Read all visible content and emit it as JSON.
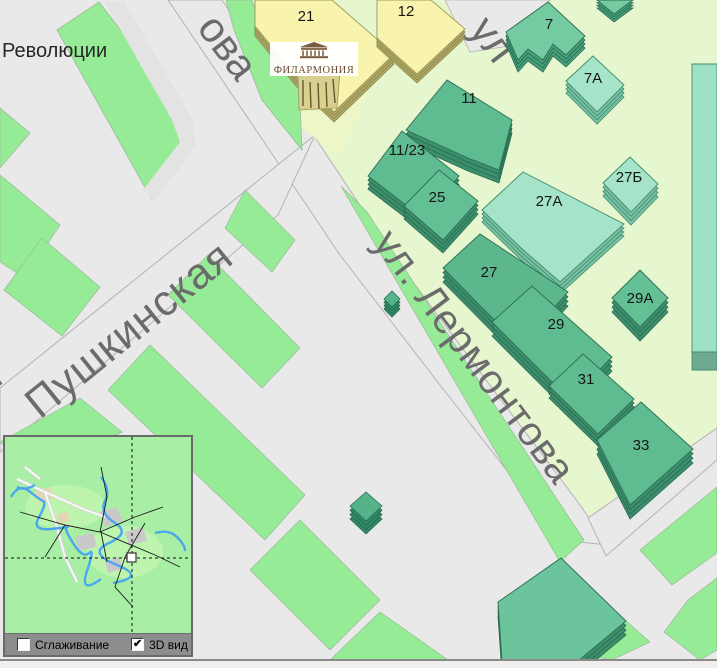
{
  "app": {
    "type": "gis-map-viewer",
    "view": "2.5D city map with overview inset"
  },
  "streets": {
    "revolution_square": "Революции",
    "pushkinskaya": "Пушкинская",
    "lermontova": "ул. Лермонтова",
    "lermontova_partial_top": "ова",
    "cross_street_partial_top": "ул",
    "edge_partial_left": "я"
  },
  "poi": {
    "philharmonic_label": "ФИЛАРМОНИЯ"
  },
  "buildings": {
    "b21": "21",
    "b12": "12",
    "b7": "7",
    "b7a": "7А",
    "b11": "11",
    "b11_23": "11/23",
    "b25": "25",
    "b27a": "27А",
    "b27b": "27Б",
    "b27": "27",
    "b29": "29",
    "b29a": "29А",
    "b31": "31",
    "b33": "33"
  },
  "minimap": {
    "smoothing": {
      "label": "Сглаживание",
      "checked": false
    },
    "view_3d": {
      "label": "3D вид",
      "checked": true
    }
  },
  "colors": {
    "road_grey": "#e9e9e9",
    "road_casing": "#b3b3b3",
    "block_green": "#96ec96",
    "lot_pale_green": "#e6f6cf",
    "building_teal_roof": "#5fbc90",
    "building_teal_side": "#3c8f6d",
    "building_teal_light_roof": "#a5e4c8",
    "building_teal_light_side": "#79c2a4",
    "building_yellow_roof": "#f8f4ae",
    "building_yellow_side": "#b1a766",
    "street_label_grey": "#6b6b6b",
    "minimap_bg": "#a8efa5",
    "minimap_river": "#4aa7f0",
    "minimap_bar": "#8d8d8d"
  }
}
